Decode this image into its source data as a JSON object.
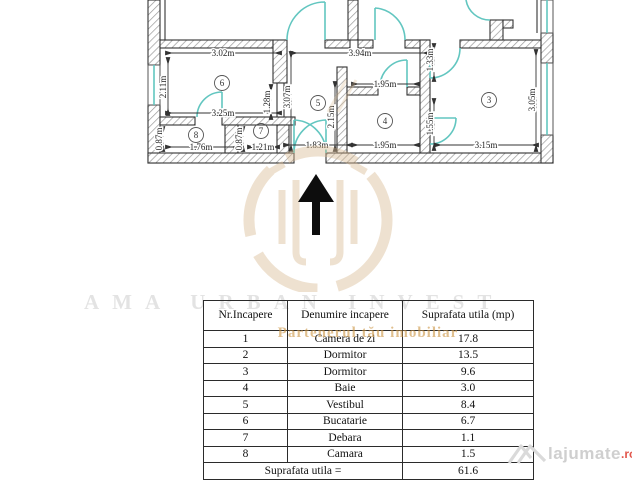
{
  "plan": {
    "dims": {
      "d302": "3.02m",
      "d394": "3.94m",
      "d211": "2.11m",
      "d128": "1.28m",
      "d307": "3.07m",
      "d215": "2.15m",
      "d195": "1.95m",
      "d133": "1.33m",
      "d155": "1.55m",
      "d305": "3.05m",
      "d315": "3.15m",
      "d325": "3.25m",
      "d087": "0.87m",
      "d176": "1.76m",
      "d121": "1.21m",
      "d183": "1.83m"
    },
    "rooms": {
      "r3": "3",
      "r4": "4",
      "r5": "5",
      "r6": "6",
      "r7": "7",
      "r8": "8"
    },
    "colors": {
      "door_window": "#62c6c0",
      "wall_line": "#333333",
      "hatch": "#999999"
    }
  },
  "watermarks": {
    "brand_top": "AMA URBAN INVEST",
    "brand_sub": "Partenerul tău imobiliar",
    "site_name": "lajumate",
    "site_tld": ".ro",
    "logo_color": "#d9ba90"
  },
  "table": {
    "headers": [
      "Nr.Incapere",
      "Denumire incapere",
      "Suprafata utila (mp)"
    ],
    "rows": [
      {
        "nr": "1",
        "name": "Camera de zi",
        "area": "17.8"
      },
      {
        "nr": "2",
        "name": "Dormitor",
        "area": "13.5"
      },
      {
        "nr": "3",
        "name": "Dormitor",
        "area": "9.6"
      },
      {
        "nr": "4",
        "name": "Baie",
        "area": "3.0"
      },
      {
        "nr": "5",
        "name": "Vestibul",
        "area": "8.4"
      },
      {
        "nr": "6",
        "name": "Bucatarie",
        "area": "6.7"
      },
      {
        "nr": "7",
        "name": "Debara",
        "area": "1.1"
      },
      {
        "nr": "8",
        "name": "Camara",
        "area": "1.5"
      }
    ],
    "total_label": "Suprafata utila =",
    "total_value": "61.6"
  }
}
